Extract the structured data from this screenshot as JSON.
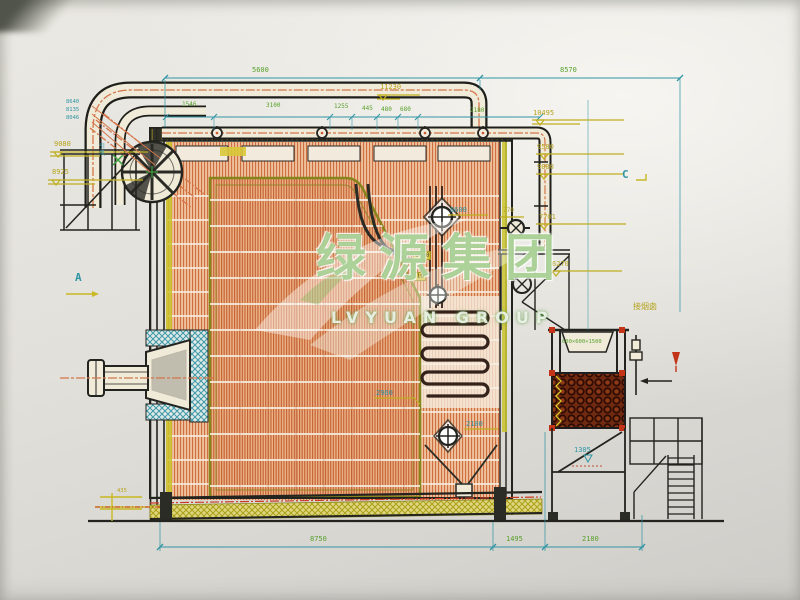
{
  "watermark": {
    "cn": "绿源集团",
    "en": "LVYUAN GROUP"
  },
  "colors": {
    "hatch_orange": "#cf6f40",
    "dim_cyan": "#2f95a5",
    "dim_green": "#57a02c",
    "elev_yellow": "#b5a31d",
    "membrane_yellow": "#c9c32c",
    "coil_red": "#702a10",
    "watermark_green": "#60a83e"
  },
  "labels": {
    "dim_top_left": "5600",
    "dim_top_right": "8570",
    "row_1": "1546",
    "row_2": "3100",
    "row_3": "1255",
    "row_4": "445",
    "row_5": "480",
    "row_6": "680",
    "row_7": "2180",
    "elev_11230": "11230",
    "elev_10495": "10495",
    "elev_9580": "9580",
    "elev_9080": "9080",
    "elev_770": "770",
    "elev_7701": "7701",
    "elev_6270": "6270",
    "left_9080": "9080",
    "left_8925": "8925",
    "stack_1": "8640",
    "stack_2": "8135",
    "stack_3": "8046",
    "mark_8600": "8600",
    "mark_2960": "2960",
    "mark_2100": "2100",
    "mark_1305": "1305",
    "mark_435": "435",
    "box_1620": "1620",
    "box_610": "610",
    "dim_bot_main": "8750",
    "dim_bot_mid": "1495",
    "dim_bot_right": "2100",
    "section_a": "A",
    "section_c": "C",
    "hopper_spec": "600×600×1500",
    "flue_note": "接烟囱",
    "drum_note": "引风"
  }
}
